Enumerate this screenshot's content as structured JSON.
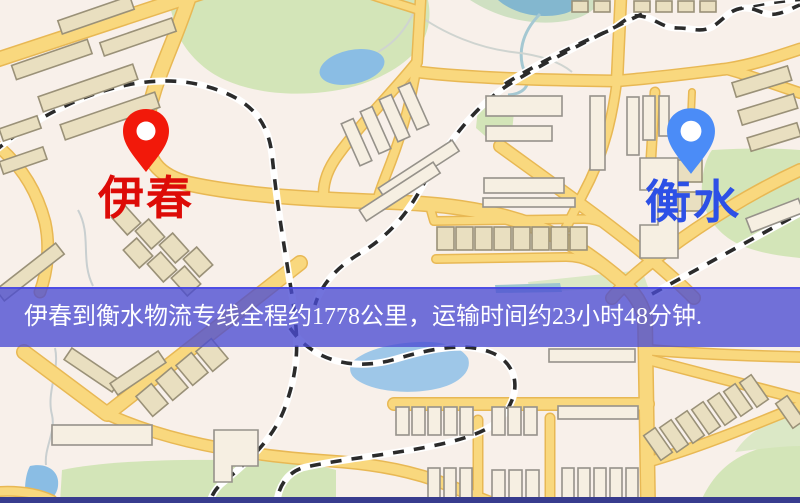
{
  "page": {
    "type": "logistics-route-map",
    "width": 800,
    "height": 503
  },
  "map": {
    "origin": {
      "city": "伊春",
      "marker_color": "#f2190a",
      "label_color": "#dd0b07"
    },
    "destination": {
      "city": "衡水",
      "marker_color": "#4b8cf7",
      "label_color": "#2d50e6"
    },
    "banner": {
      "text": "伊春到衡水物流专线全程约1778公里，运输时间约23小时48分钟.",
      "distance_km": 1778,
      "duration_hours": 23,
      "duration_minutes": 48,
      "background": "#4a4cd2",
      "text_color": "#ffffff"
    },
    "legend_colors": {
      "map_background": "#f8f0ea",
      "road": "#f9d87e",
      "road_casing": "#e8b854",
      "park": "#d3e5b8",
      "water": "#8abde4",
      "railway": "#2b2b2b",
      "building": "#e9dfc0"
    }
  }
}
